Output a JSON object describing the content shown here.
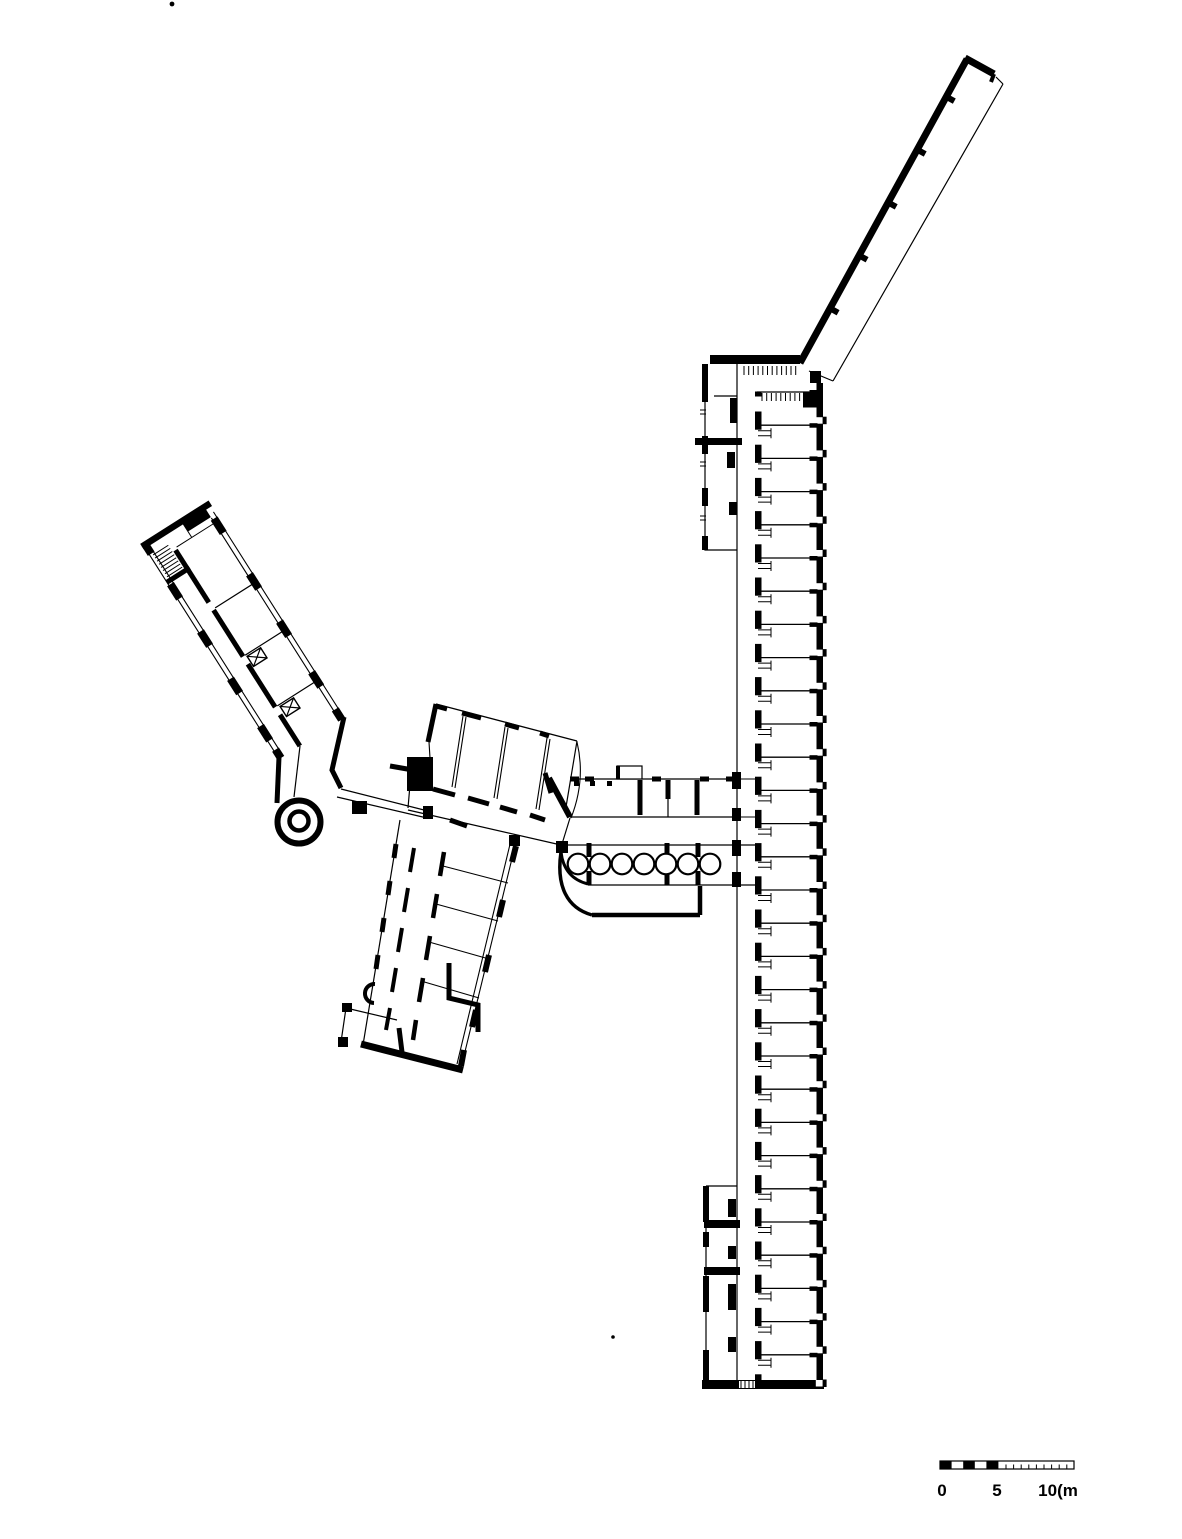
{
  "scale_bar": {
    "labels": [
      "0",
      "5",
      "10(m"
    ]
  },
  "plan": {
    "patient_wing": {
      "rooms": 30
    },
    "colonnade": {
      "columns": 7
    },
    "terrace_wing": {
      "wall_stubs": 5
    },
    "west_wing": {
      "window_bays": 5,
      "x_shafts": 2
    }
  },
  "colors": {
    "ink": "#000000",
    "paper": "#ffffff"
  }
}
